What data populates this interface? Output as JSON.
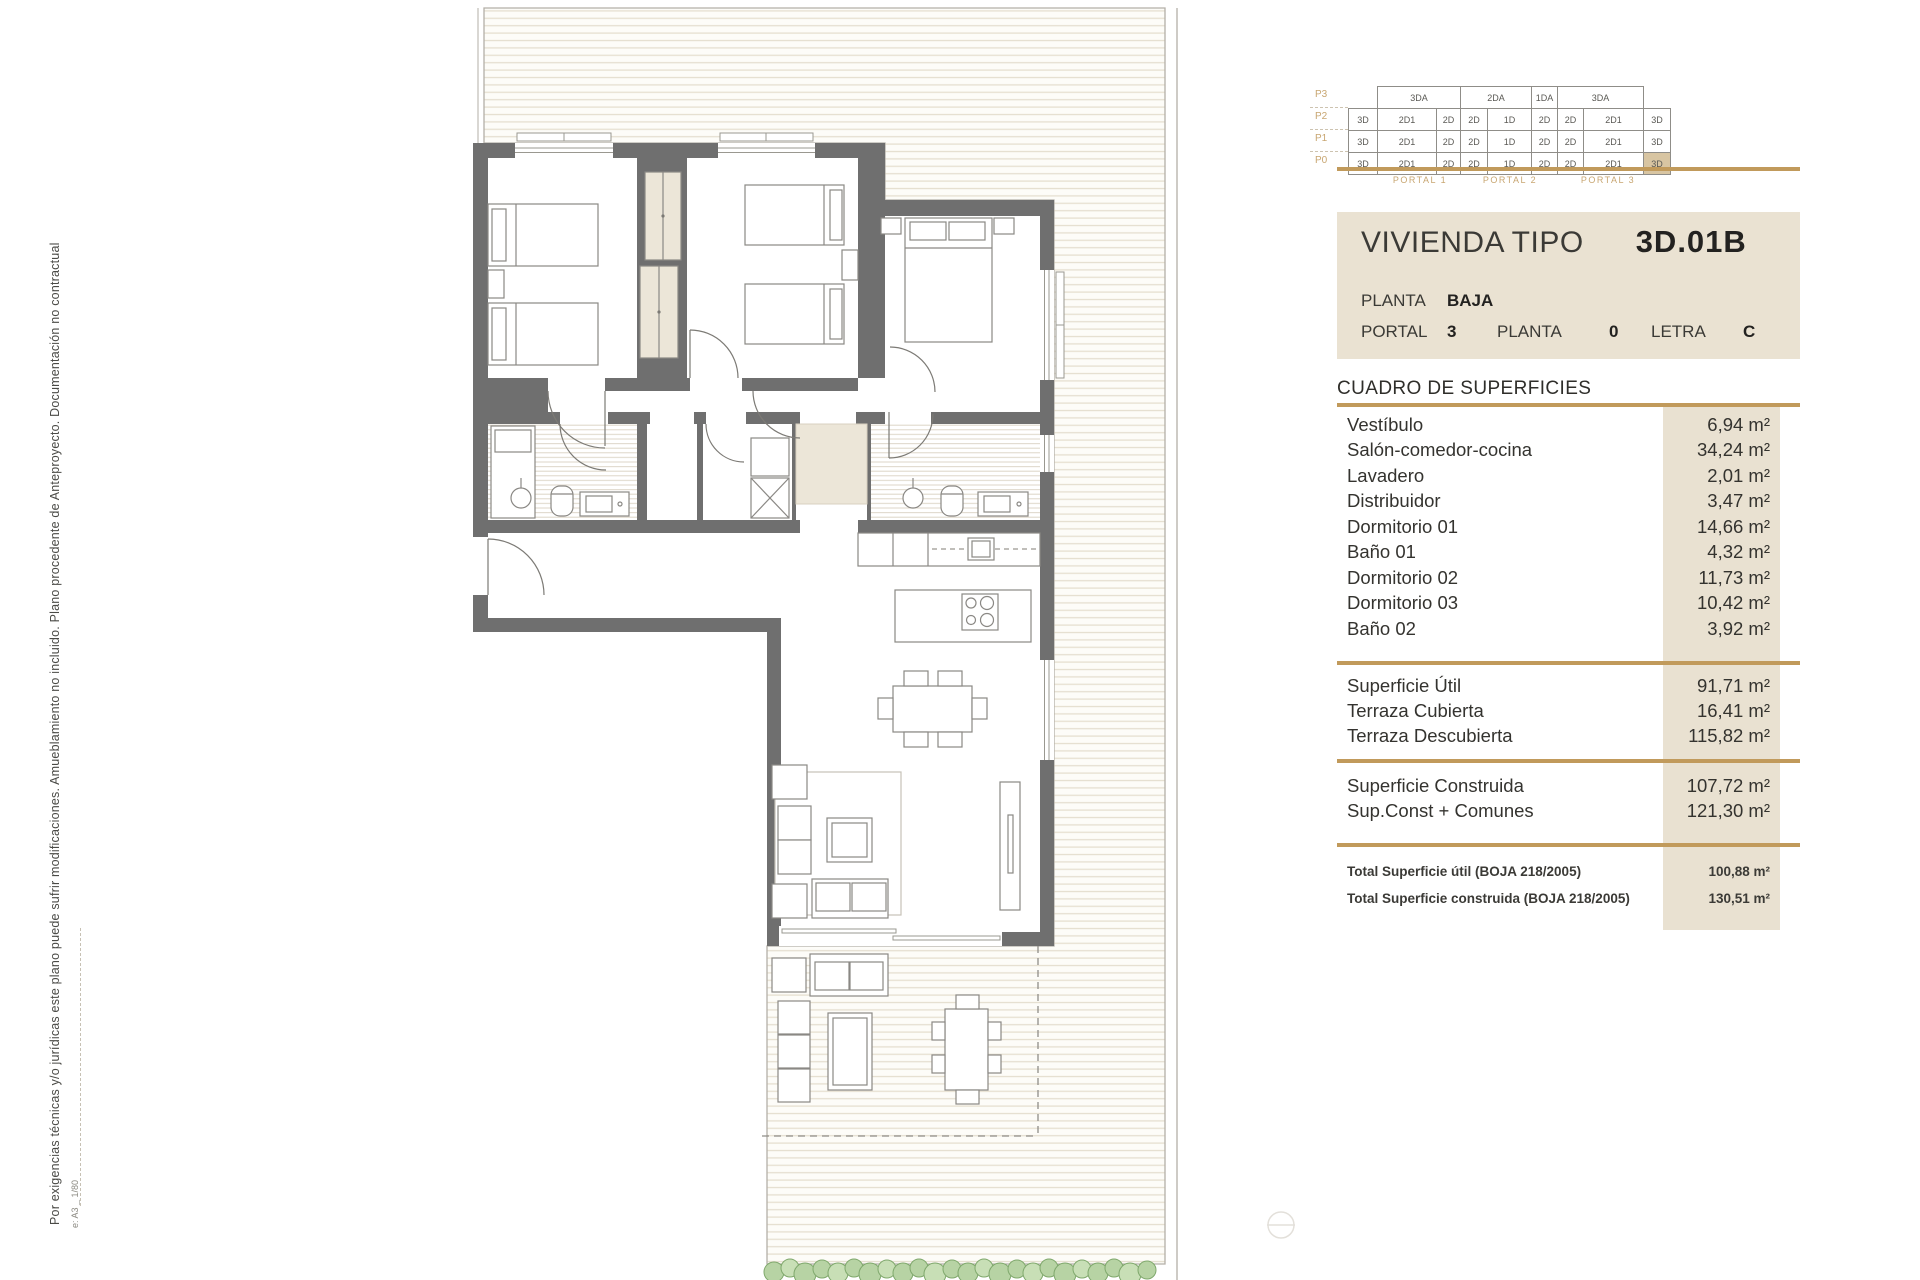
{
  "header": {
    "title": "VIVIENDA TIPO",
    "code": "3D.01B",
    "planta_label": "PLANTA",
    "planta_value": "BAJA",
    "portal_label": "PORTAL",
    "portal_value": "3",
    "planta2_label": "PLANTA",
    "planta2_value": "0",
    "letra_label": "LETRA",
    "letra_value": "C"
  },
  "keyplan": {
    "floors": [
      {
        "label": "P3",
        "cells": [
          "3DA",
          "2DA",
          "1DA",
          "3DA"
        ]
      },
      {
        "label": "P2",
        "cells": [
          "3D",
          "2D1",
          "2D",
          "2D",
          "1D",
          "2D",
          "2D",
          "2D1",
          "3D"
        ]
      },
      {
        "label": "P1",
        "cells": [
          "3D",
          "2D1",
          "2D",
          "2D",
          "1D",
          "2D",
          "2D",
          "2D1",
          "3D"
        ]
      },
      {
        "label": "P0",
        "cells": [
          "3D",
          "2D1",
          "2D",
          "2D",
          "1D",
          "2D",
          "2D",
          "2D1",
          "3D"
        ]
      }
    ],
    "highlighted_unit": "P0 3D (Portal 3)",
    "portals": [
      "PORTAL 1",
      "PORTAL 2",
      "PORTAL 3"
    ]
  },
  "surfaces": {
    "title": "CUADRO DE SUPERFICIES",
    "rooms": [
      {
        "label": "Vestíbulo",
        "value": "6,94 m²"
      },
      {
        "label": "Salón-comedor-cocina",
        "value": "34,24 m²"
      },
      {
        "label": "Lavadero",
        "value": "2,01 m²"
      },
      {
        "label": "Distribuidor",
        "value": "3,47 m²"
      },
      {
        "label": "Dormitorio 01",
        "value": "14,66 m²"
      },
      {
        "label": "Baño 01",
        "value": "4,32 m²"
      },
      {
        "label": "Dormitorio 02",
        "value": "11,73 m²"
      },
      {
        "label": "Dormitorio 03",
        "value": "10,42 m²"
      },
      {
        "label": "Baño 02",
        "value": "3,92 m²"
      }
    ],
    "useful": [
      {
        "label": "Superficie Útil",
        "value": "91,71 m²"
      },
      {
        "label": "Terraza Cubierta",
        "value": "16,41 m²"
      },
      {
        "label": "Terraza Descubierta",
        "value": "115,82 m²"
      }
    ],
    "built": [
      {
        "label": "Superficie Construida",
        "value": "107,72 m²"
      },
      {
        "label": "Sup.Const + Comunes",
        "value": "121,30 m²"
      }
    ],
    "totals": [
      {
        "label": "Total Superficie útil (BOJA 218/2005)",
        "value": "100,88 m²"
      },
      {
        "label": "Total Superficie construida (BOJA 218/2005)",
        "value": "130,51 m²"
      }
    ]
  },
  "notes": {
    "side": "Por exigencias técnicas y/o jurídicas este plano puede sufrir modificaciones. Amueblamiento no incluido. Plano procedente de Anteproyecto. Documentación no contractual",
    "scale": "e: A3 _ 1/80"
  },
  "colors": {
    "accent_gold": "#c19a5b",
    "beige": "#eae2d2",
    "wall_gray": "#6f6f6f",
    "highlight_tan": "#d8c5a2",
    "hedge_green": "#b7d3a4"
  }
}
